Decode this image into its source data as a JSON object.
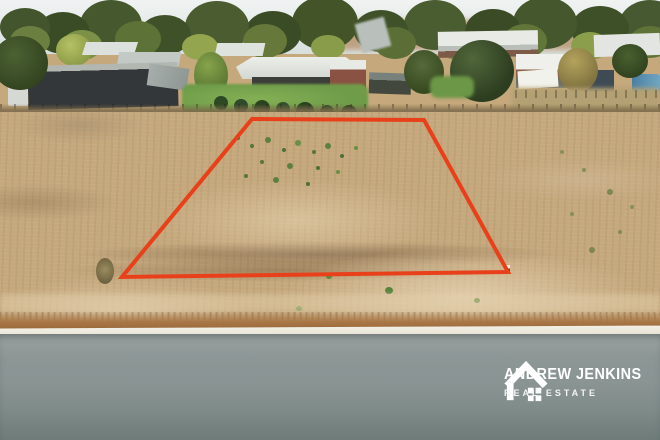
{
  "watermark": {
    "line1": "ANDREW JENKINS",
    "line2": "REAL ESTATE",
    "icon": "house-outline-icon"
  },
  "boundary": {
    "color": "#e8401a",
    "points": [
      [
        252,
        119
      ],
      [
        424,
        120
      ],
      [
        508,
        272
      ],
      [
        122,
        277
      ]
    ]
  },
  "palette": {
    "boundary-red": "#e8401a",
    "sky": "#e2e8e7",
    "dirt-tan": "#c5a87c",
    "verge-brown": "#a97746",
    "lawn-green": "#6f9c49",
    "curb-white": "#e7e2d3",
    "road-gray": "#8c9695",
    "road-dark": "#6e7b79",
    "pool-blue": "#4b7fa2",
    "watermark-white": "#ffffff"
  }
}
